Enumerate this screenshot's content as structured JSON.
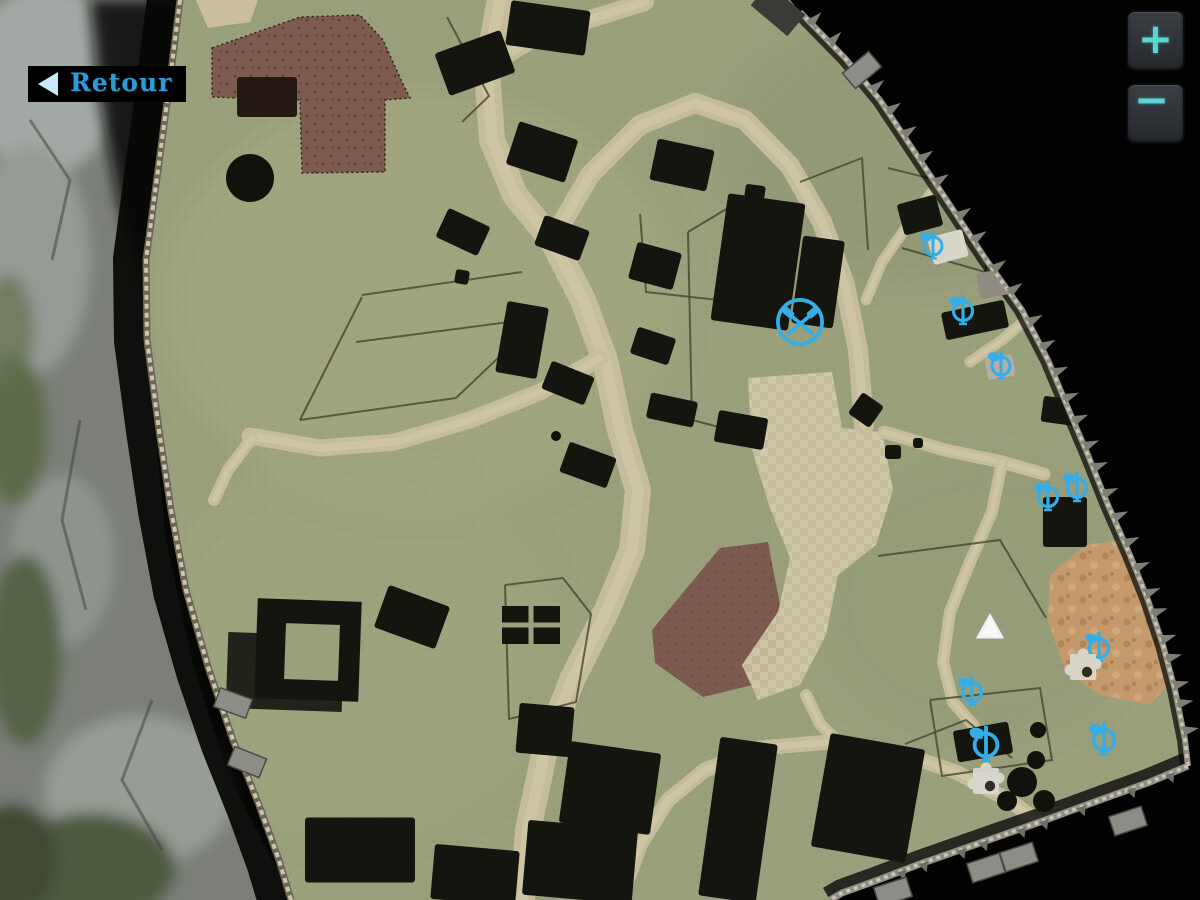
{
  "ui": {
    "back_button": {
      "label": "Retour"
    },
    "zoom_in_label": "+",
    "zoom_out_label": "−"
  },
  "colors": {
    "marker_blue": "#35aee8",
    "button_glyph_teal": "#57d7d3",
    "back_label_blue": "#2e9ad6",
    "village_green": "#9aa07c",
    "road_tan": "#c8be9e",
    "field_brown": "#7d5b51",
    "dirt_orange": "#c49a6d",
    "building_black": "#15150f"
  },
  "map": {
    "markers": [
      {
        "id": "m1",
        "type": "workshop",
        "x": 800,
        "y": 322,
        "scale": 1.05
      },
      {
        "id": "m2",
        "type": "poi",
        "x": 933,
        "y": 246,
        "scale": 0.95
      },
      {
        "id": "m3",
        "type": "poi",
        "x": 963,
        "y": 311,
        "scale": 1
      },
      {
        "id": "m4",
        "type": "poi",
        "x": 1001,
        "y": 366,
        "scale": 0.95
      },
      {
        "id": "m5",
        "type": "poi",
        "x": 1048,
        "y": 497,
        "scale": 1
      },
      {
        "id": "m6",
        "type": "poi",
        "x": 1077,
        "y": 488,
        "scale": 1
      },
      {
        "id": "m7",
        "type": "poi",
        "x": 1099,
        "y": 648,
        "scale": 1
      },
      {
        "id": "m8",
        "type": "poi",
        "x": 972,
        "y": 692,
        "scale": 1
      },
      {
        "id": "m9",
        "type": "poi",
        "x": 986,
        "y": 745,
        "scale": 1.2
      },
      {
        "id": "m10",
        "type": "poi",
        "x": 1104,
        "y": 740,
        "scale": 1.1
      }
    ],
    "player_marker": {
      "type": "triangle",
      "x": 990,
      "y": 628
    },
    "puzzle_markers": [
      {
        "x": 1083,
        "y": 666
      },
      {
        "x": 986,
        "y": 780
      }
    ]
  }
}
